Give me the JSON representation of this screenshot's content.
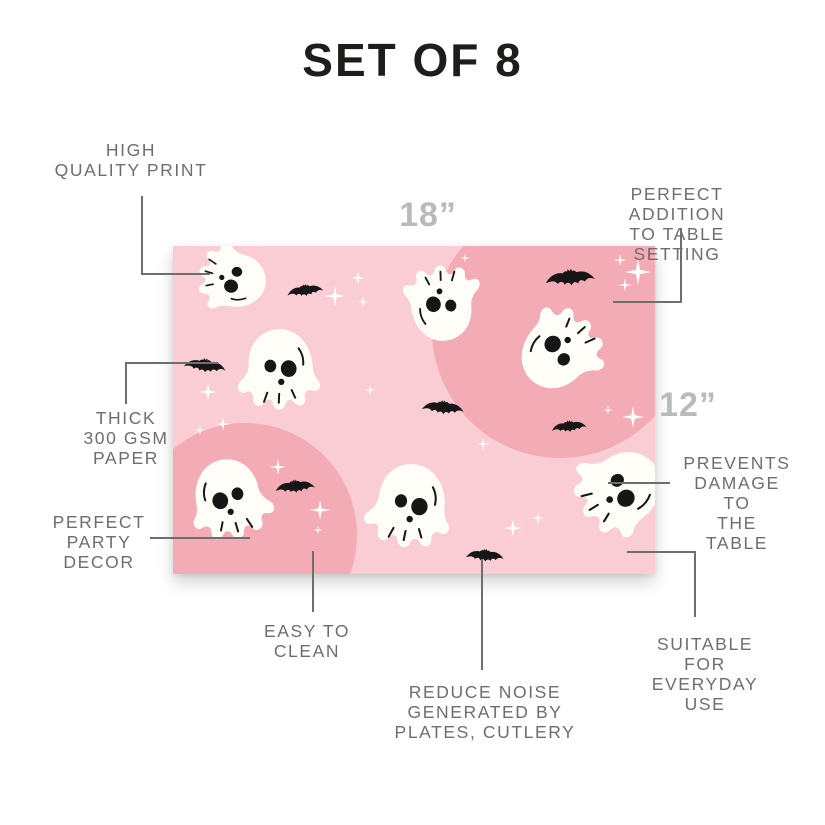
{
  "title": "SET OF 8",
  "dimensions": {
    "width_label": "18”",
    "height_label": "12”"
  },
  "callouts": {
    "high_quality": "HIGH\nQUALITY PRINT",
    "table_setting": "PERFECT ADDITION\nTO TABLE SETTING",
    "thick_paper": "THICK\n300 GSM\nPAPER",
    "party_decor": "PERFECT\nPARTY\nDECOR",
    "easy_clean": "EASY TO\nCLEAN",
    "reduce_noise": "REDUCE NOISE\nGENERATED BY\nPLATES, CUTLERY",
    "everyday_use": "SUITABLE FOR\nEVERYDAY USE",
    "prevents_damage": "PREVENTS\nDAMAGE TO\nTHE TABLE"
  },
  "colors": {
    "title": "#1d1d1b",
    "label": "#6d6e70",
    "dimension": "#b9babc",
    "line": "#6e6e6e",
    "mat_light": "#f9cdd3",
    "mat_dark": "#f3abb5",
    "ghost": "#fffdf8",
    "ink": "#161616",
    "sparkle": "#ffffff"
  }
}
